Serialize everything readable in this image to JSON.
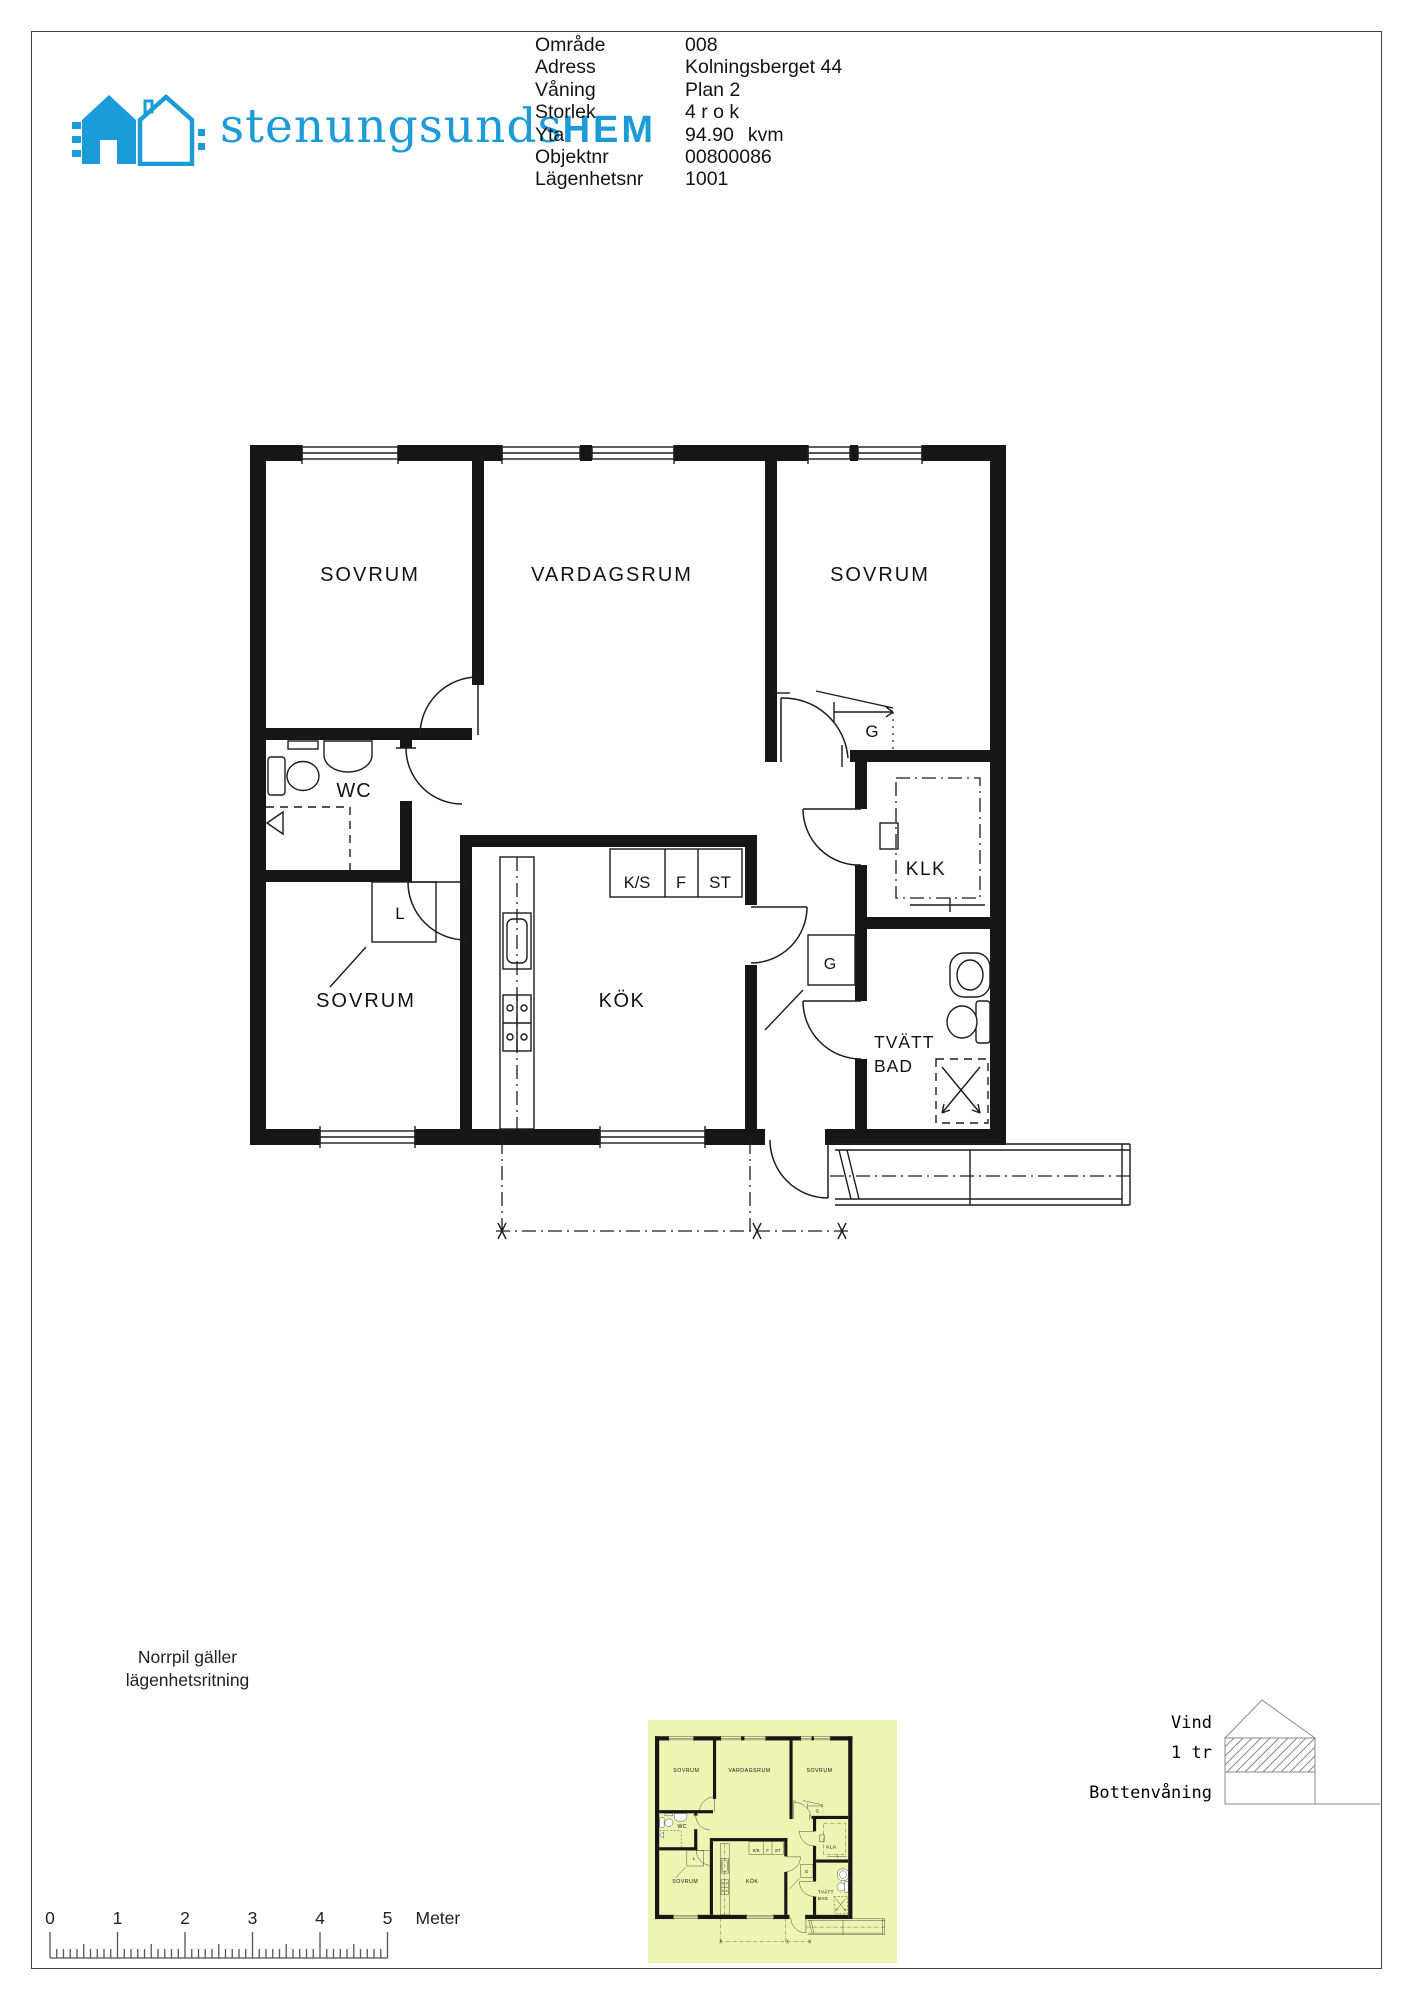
{
  "header": {
    "logo": {
      "text_main": "stenungsunds",
      "text_bold": "HEM"
    },
    "meta": [
      {
        "label": "Område",
        "value": "008",
        "suffix": ""
      },
      {
        "label": "Adress",
        "value": "Kolningsberget 44",
        "suffix": ""
      },
      {
        "label": "Våning",
        "value": "Plan 2",
        "suffix": ""
      },
      {
        "label": "Storlek",
        "value": "4 r o k",
        "suffix": ""
      },
      {
        "label": "Yta",
        "value": "94.90",
        "suffix": "kvm"
      },
      {
        "label": "Objektnr",
        "value": "00800086",
        "suffix": ""
      },
      {
        "label": "Lägenhetsnr",
        "value": "1001",
        "suffix": ""
      }
    ]
  },
  "floor_plan": {
    "labels": [
      {
        "text": "SOVRUM",
        "x": 120,
        "y": 136,
        "size": 20,
        "ls": 2,
        "anchor": "middle"
      },
      {
        "text": "VARDAGSRUM",
        "x": 362,
        "y": 136,
        "size": 20,
        "ls": 2,
        "anchor": "middle"
      },
      {
        "text": "SOVRUM",
        "x": 630,
        "y": 136,
        "size": 20,
        "ls": 2,
        "anchor": "middle"
      },
      {
        "text": "WC",
        "x": 104,
        "y": 352,
        "size": 20,
        "ls": 1,
        "anchor": "middle"
      },
      {
        "text": "L",
        "x": 150,
        "y": 474,
        "size": 17,
        "ls": 0,
        "anchor": "middle"
      },
      {
        "text": "K/S",
        "x": 387,
        "y": 443,
        "size": 16.5,
        "ls": 0,
        "anchor": "middle"
      },
      {
        "text": "F",
        "x": 431,
        "y": 443,
        "size": 16.5,
        "ls": 0,
        "anchor": "middle"
      },
      {
        "text": "ST",
        "x": 470,
        "y": 443,
        "size": 17,
        "ls": 0,
        "anchor": "middle"
      },
      {
        "text": "SOVRUM",
        "x": 116,
        "y": 562,
        "size": 20,
        "ls": 2,
        "anchor": "middle"
      },
      {
        "text": "KÖK",
        "x": 372,
        "y": 562,
        "size": 20,
        "ls": 1.5,
        "anchor": "middle"
      },
      {
        "text": "G",
        "x": 622,
        "y": 292,
        "size": 17,
        "ls": 0,
        "anchor": "middle"
      },
      {
        "text": "KLK",
        "x": 676,
        "y": 430,
        "size": 19,
        "ls": 1.5,
        "anchor": "middle"
      },
      {
        "text": "G",
        "x": 580,
        "y": 524,
        "size": 16,
        "ls": 0,
        "anchor": "middle"
      },
      {
        "text": "TVÄTT",
        "x": 624,
        "y": 603,
        "size": 17.5,
        "ls": 1,
        "anchor": "start"
      },
      {
        "text": "BAD",
        "x": 624,
        "y": 627,
        "size": 17.5,
        "ls": 1,
        "anchor": "start"
      }
    ]
  },
  "footer": {
    "north_note_line1": "Norrpil gäller",
    "north_note_line2": "lägenhetsritning",
    "section": {
      "labels": [
        "Vind",
        "1 tr",
        "Bottenvåning"
      ]
    },
    "scale_bar": {
      "ticks": [
        "0",
        "1",
        "2",
        "3",
        "4",
        "5"
      ],
      "unit": "Meter"
    }
  },
  "colors": {
    "brand": "#1b9bd8",
    "thumb_bg": "#edf5b3",
    "ink": "#161616"
  }
}
